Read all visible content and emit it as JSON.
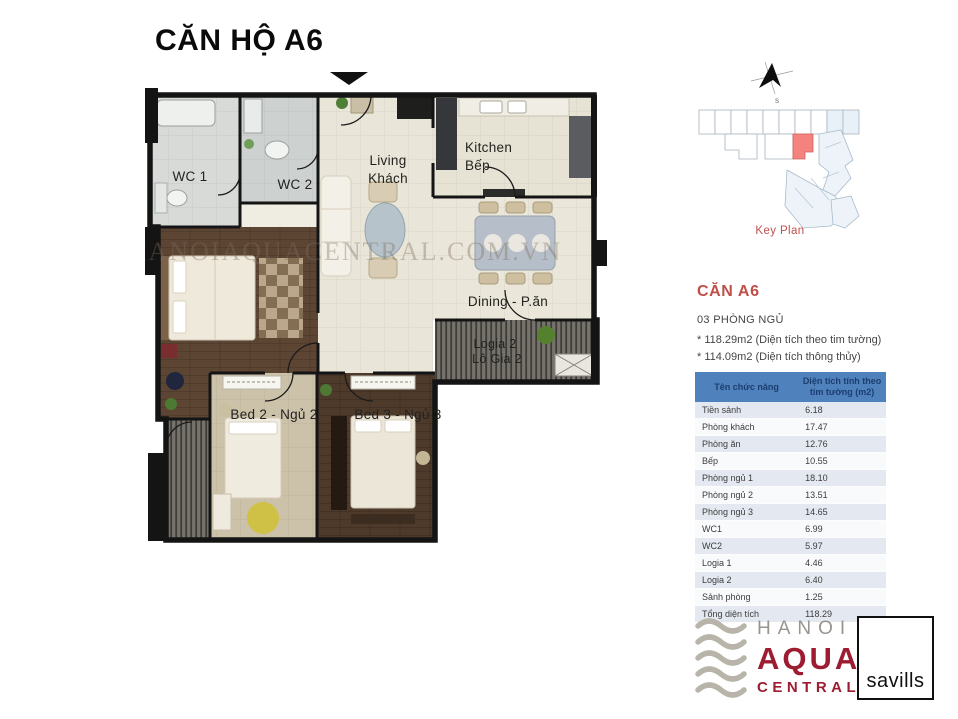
{
  "page": {
    "title": "CĂN HỘ A6",
    "watermark": "HANOIAQUACENTRAL.COM.VN"
  },
  "floor_plan": {
    "labels": {
      "wc1": "WC 1",
      "wc2": "WC 2",
      "living1": "Living",
      "living2": "Khách",
      "kitchen1": "Kitchen",
      "kitchen2": "Bếp",
      "dining": "Dining - P.ăn",
      "logia2a": "Logia 2",
      "logia2b": "Lô Gia 2",
      "bed2": "Bed 2 - Ngủ 2",
      "bed3": "Bed 3 - Ngủ 3"
    }
  },
  "key_plan": {
    "caption": "Key Plan"
  },
  "unit_info": {
    "name": "CĂN A6",
    "bedrooms": "03 PHÒNG NGỦ",
    "area_line1": "* 118.29m2 (Diện tích theo tim tường)",
    "area_line2": "* 114.09m2 (Diện tích thông thủy)"
  },
  "area_table": {
    "headers": [
      "Tên chức năng",
      "Diện tích tính theo tim tường (m2)"
    ],
    "rows": [
      [
        "Tiền sảnh",
        "6.18"
      ],
      [
        "Phòng khách",
        "17.47"
      ],
      [
        "Phòng ăn",
        "12.76"
      ],
      [
        "Bếp",
        "10.55"
      ],
      [
        "Phòng ngủ 1",
        "18.10"
      ],
      [
        "Phòng ngủ 2",
        "13.51"
      ],
      [
        "Phòng ngủ 3",
        "14.65"
      ],
      [
        "WC1",
        "6.99"
      ],
      [
        "WC2",
        "5.97"
      ],
      [
        "Logia 1",
        "4.46"
      ],
      [
        "Logia 2",
        "6.40"
      ],
      [
        "Sảnh phòng",
        "1.25"
      ],
      [
        "Tổng diện tích",
        "118.29"
      ]
    ]
  },
  "branding": {
    "developer": {
      "line1": "HANOI",
      "line2": "AQUA",
      "line3": "CENTRAL"
    },
    "agency": "savills"
  },
  "colors": {
    "accent_red": "#c0504d",
    "table_header_blue": "#4f81bd",
    "table_band_blue": "#e4e9f1",
    "keyplan_highlight": "#f4837d",
    "brand_maroon": "#9d1c31",
    "wall_black": "#141414"
  }
}
